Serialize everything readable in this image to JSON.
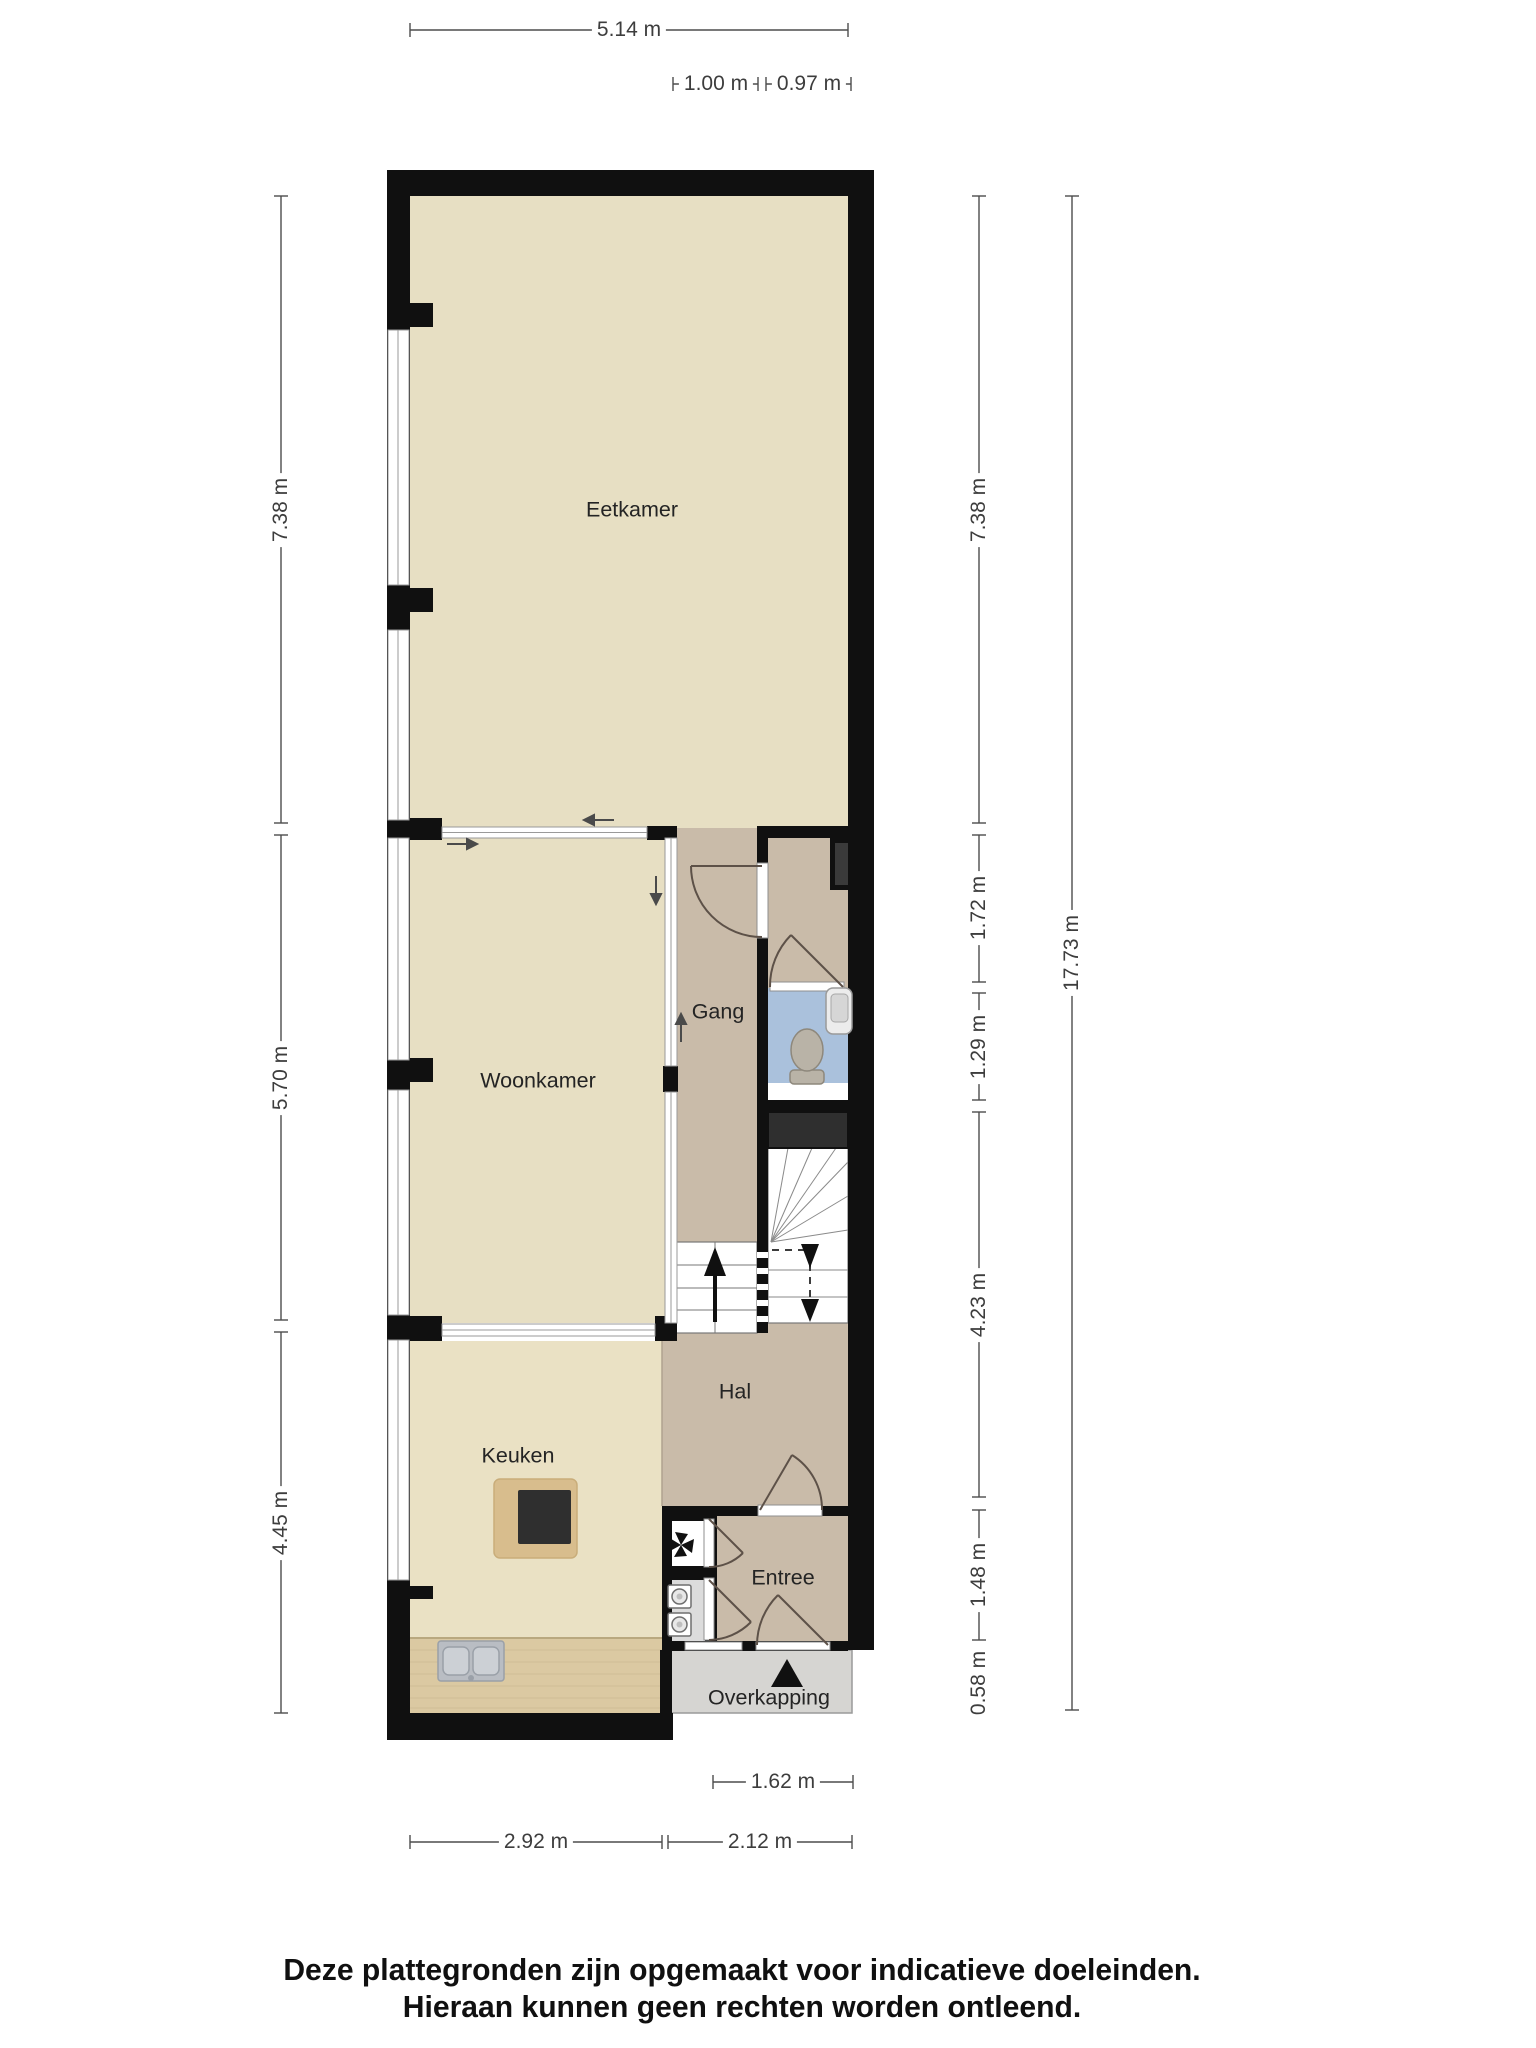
{
  "rooms": {
    "eetkamer": "Eetkamer",
    "woonkamer": "Woonkamer",
    "gang": "Gang",
    "keuken": "Keuken",
    "hal": "Hal",
    "entree": "Entree",
    "overkapping": "Overkapping"
  },
  "dimensions": {
    "top_width": "5.14 m",
    "gang_width": "1.00 m",
    "toilet_width": "0.97 m",
    "left_eetkamer": "7.38 m",
    "left_woonkamer": "5.70 m",
    "left_keuken": "4.45 m",
    "right_eetkamer": "7.38 m",
    "right_gang": "1.72 m",
    "right_toilet": "1.29 m",
    "right_hal": "4.23 m",
    "right_entree": "1.48 m",
    "right_overkapping": "0.58 m",
    "total_height": "17.73 m",
    "overkapping_width": "1.62 m",
    "keuken_width": "2.92 m",
    "hal_width": "2.12 m"
  },
  "footer": {
    "line1": "Deze plattegronden zijn opgemaakt voor indicatieve doeleinden.",
    "line2": "Hieraan kunnen geen rechten worden ontleend."
  },
  "icons": {
    "entrance_marker": "black-triangle-up",
    "stairs_up": "arrow-up",
    "stairs_down": "dashed-path-arrows-down",
    "sliding_door_arrows": "direction-arrows",
    "toilet": "toilet-top-view",
    "washbasin": "wall-basin",
    "boiler": "propeller-fan",
    "washing_machine": "front-load-drum",
    "dryer": "front-load-drum",
    "kitchen_sink": "double-sink",
    "cooktop": "dark-square-hob"
  },
  "colors": {
    "wall": "#101010",
    "floor_living": "#e7dfc3",
    "floor_kitchen": "#eae1c4",
    "floor_hall": "#c9bba9",
    "floor_toilet": "#aac1dc",
    "floor_porch": "#d6d5d2",
    "floor_closet": "#dcdcdc",
    "counter_wood": "#dbc9a2",
    "island_wood": "#d8bd8d",
    "stove": "#2f2f2f",
    "dimension_line": "#4d4d4d"
  }
}
